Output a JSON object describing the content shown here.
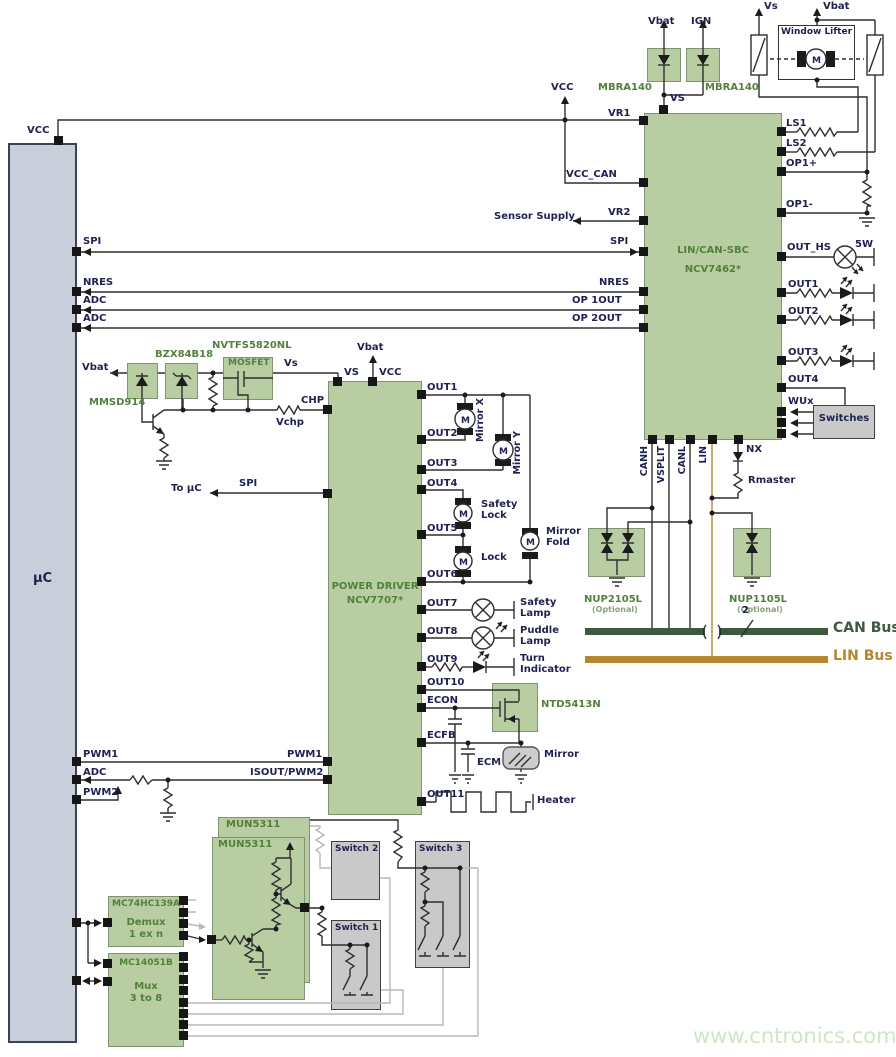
{
  "icons": {
    "motor_m": "M"
  },
  "watermark": "www.cntronics.com",
  "mcu": {
    "label": "µC",
    "vcc": "VCC",
    "spi": "SPI",
    "nres": "NRES",
    "adc_a": "ADC",
    "adc_b": "ADC",
    "pwm1": "PWM1",
    "adc_c": "ADC",
    "pwm2": "PWM2"
  },
  "top": {
    "vs": "Vs",
    "vbat": "Vbat",
    "vbat_diode": "Vbat",
    "ign": "IGN",
    "mbra_left": "MBRA140",
    "mbra_right": "MBRA140",
    "window_lifter": "Window Lifter",
    "vcc": "VCC",
    "vs_pin": "VS"
  },
  "sbc": {
    "title1": "LIN/CAN-SBC",
    "title2": "NCV7462*",
    "vr1": "VR1",
    "vcc_can": "VCC_CAN",
    "vr2": "VR2",
    "sensor_supply": "Sensor Supply",
    "spi": "SPI",
    "nres": "NRES",
    "op1out": "OP 1OUT",
    "op2out": "OP 2OUT",
    "ls1": "LS1",
    "ls2": "LS2",
    "op1_plus": "OP1+",
    "op1_minus": "OP1-",
    "out_hs": "OUT_HS",
    "watt": "5W",
    "out1": "OUT1",
    "out2": "OUT2",
    "out3": "OUT3",
    "out4": "OUT4",
    "wux": "WUx",
    "switches": "Switches",
    "canh": "CANH",
    "vsplit": "VSPLIT",
    "canl": "CANL",
    "lin": "LIN",
    "nx": "NX",
    "rmaster": "Rmaster"
  },
  "tvs": {
    "nup2105l": "NUP2105L",
    "nup2105l_note": "(Optional)",
    "nup1105l": "NUP1105L",
    "nup1105l_note": "(Optional)"
  },
  "bus": {
    "can": "CAN Bus",
    "lin": "LIN Bus",
    "wires": "2"
  },
  "frontend": {
    "vbat": "Vbat",
    "mmsd914": "MMSD914",
    "bzx84b18": "BZX84B18",
    "nvtfs5820nl": "NVTFS5820NL",
    "mosfet": "MOSFET",
    "vs": "Vs",
    "chp": "CHP",
    "vchp": "Vchp",
    "to_uc": "To µC",
    "spi": "SPI"
  },
  "driver": {
    "title1": "POWER DRIVER",
    "title2": "NCV7707*",
    "vs": "VS",
    "vcc": "VCC",
    "vbat": "Vbat",
    "out": [
      "OUT1",
      "OUT2",
      "OUT3",
      "OUT4",
      "OUT5",
      "OUT6",
      "OUT7",
      "OUT8",
      "OUT9",
      "OUT10",
      "OUT11"
    ],
    "econ": "ECON",
    "ecfb": "ECFB",
    "pwm1": "PWM1",
    "isout_pwm2": "ISOUT/PWM2"
  },
  "loads": {
    "mirror_x": "Mirror X",
    "mirror_y": "Mirror Y",
    "safety_lock": "Safety Lock",
    "lock": "Lock",
    "mirror_fold": "Mirror Fold",
    "safety_lamp": "Safety Lamp",
    "puddle_lamp": "Puddle Lamp",
    "turn_indicator": "Turn Indicator",
    "ntd5413n": "NTD5413N",
    "ecm": "ECM",
    "mirror": "Mirror",
    "heater": "Heater"
  },
  "bottom": {
    "mun_back": "MUN5311",
    "mun_front": "MUN5311",
    "demux_part": "MC74HC139A",
    "demux_fn1": "Demux",
    "demux_fn2": "1 ex n",
    "mux_part": "MC14051B",
    "mux_fn1": "Mux",
    "mux_fn2": "3 to 8",
    "switch1": "Switch 1",
    "switch2": "Switch 2",
    "switch3": "Switch 3"
  }
}
